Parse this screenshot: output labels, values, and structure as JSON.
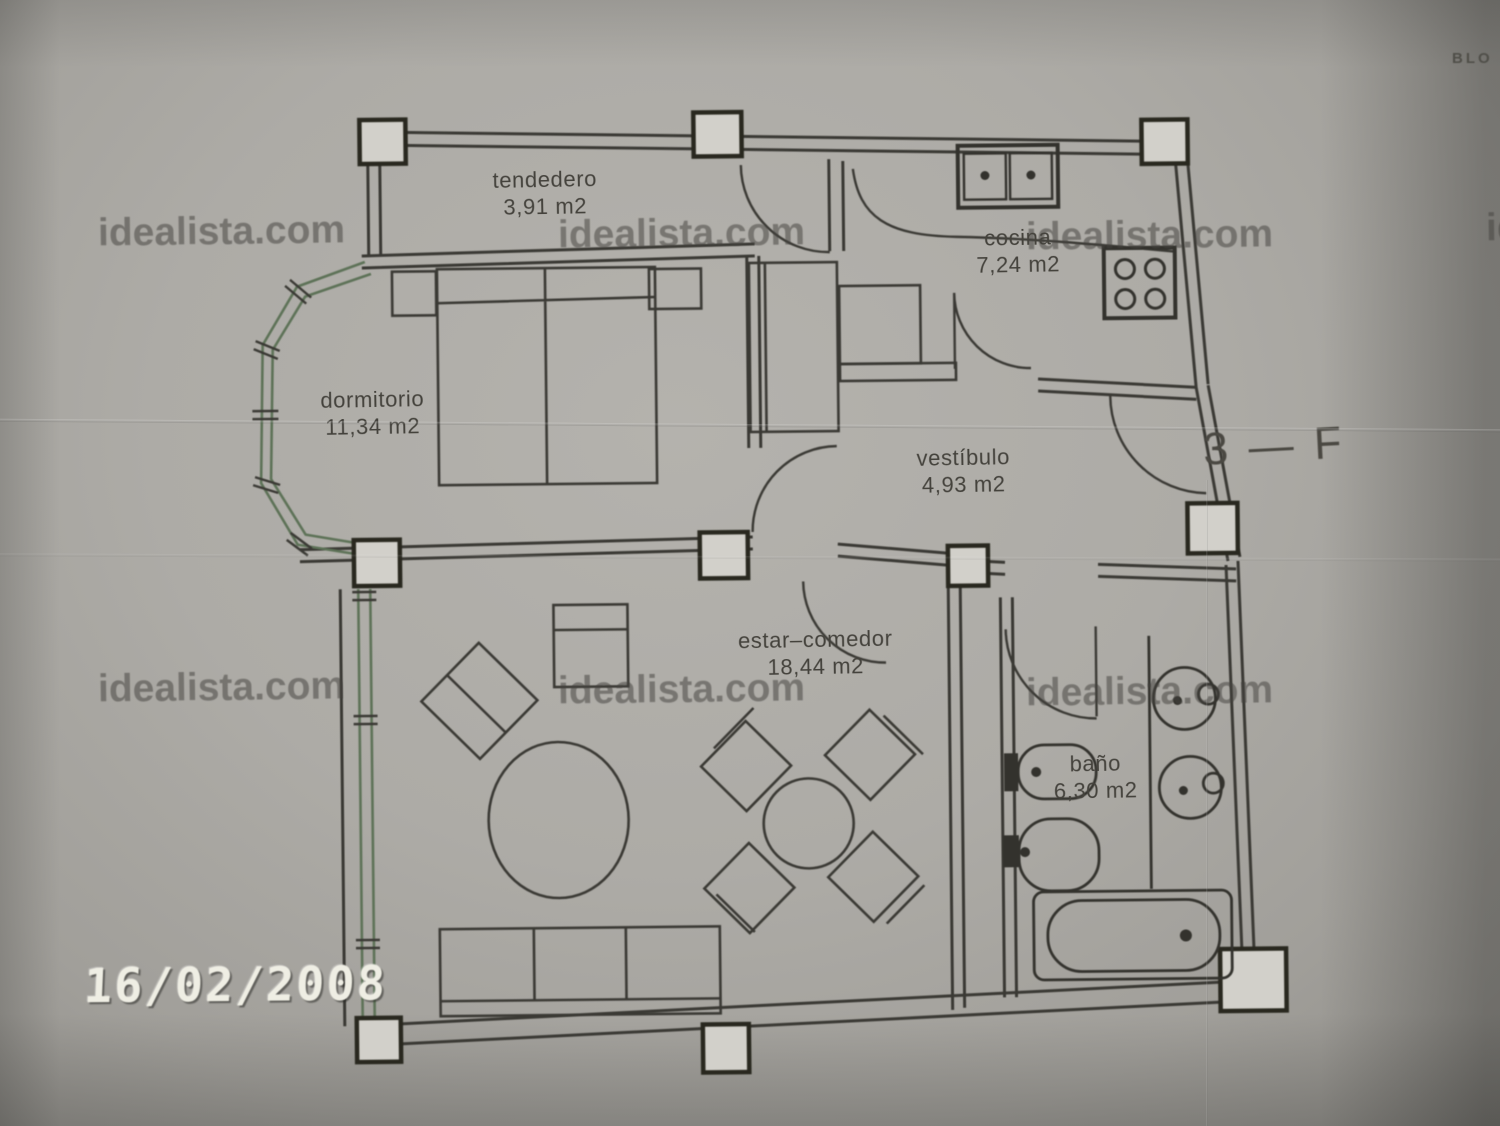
{
  "photo": {
    "date_stamp": "16/02/2008",
    "unit_label": "3 — F",
    "corner_text": "BLO"
  },
  "watermark": {
    "text": "idealista.com"
  },
  "rooms": [
    {
      "id": "tendedero",
      "name": "tendedero",
      "area": "3,91 m2"
    },
    {
      "id": "cocina",
      "name": "cocina",
      "area": "7,24 m2"
    },
    {
      "id": "dormitorio",
      "name": "dormitorio",
      "area": "11,34 m2"
    },
    {
      "id": "vestibulo",
      "name": "vestíbulo",
      "area": "4,93 m2"
    },
    {
      "id": "estar-comedor",
      "name": "estar–comedor",
      "area": "18,44 m2"
    },
    {
      "id": "bano",
      "name": "baño",
      "area": "6,30 m2"
    }
  ],
  "plan_symbols": [
    "double-bed",
    "nightstand",
    "closet",
    "wardrobe",
    "kitchen-sink",
    "stove",
    "sofa",
    "armchair",
    "side-chair",
    "coffee-table",
    "dining-table",
    "dining-chair",
    "toilet",
    "bidet",
    "washbasin",
    "bathtub",
    "door-swing",
    "window-wall",
    "pillar"
  ],
  "colors": {
    "paper": "#aeaca7",
    "plan_line": "#3a3934",
    "window_green": "#5d7257",
    "watermark": "#44423d",
    "date_stamp": "#efeee4"
  }
}
